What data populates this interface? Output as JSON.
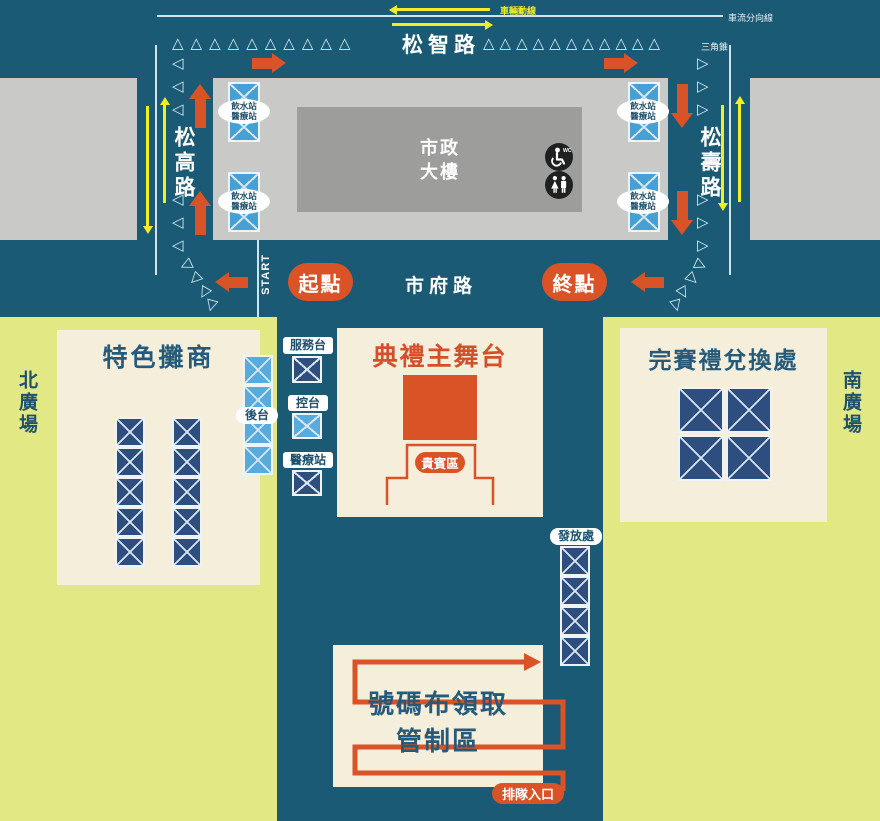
{
  "colors": {
    "background": "#1a5a74",
    "accent_red": "#d95327",
    "plaza_green": "#e2e884",
    "cream": "#f4eedb",
    "navy_box": "#2e4e7f",
    "light_blue_box": "#58abdd",
    "station_blue": "#45a0d6",
    "yellow": "#f2ee25",
    "cone_blue": "#d6edf6",
    "title_blue": "#265a7b"
  },
  "icons": {
    "cone_up": "△",
    "cone_left": "◁",
    "cone_right": "▷"
  },
  "top_legend": {
    "vehicle_route": "車輛動線",
    "lane_divider": "車流分向線",
    "cone": "三角錐"
  },
  "roads": {
    "top": "松智路",
    "left": "松高路",
    "right": "松壽路",
    "bottom": "市府路",
    "start_en": "START"
  },
  "route_points": {
    "start": "起點",
    "finish": "終點"
  },
  "building": {
    "line1": "市政",
    "line2": "大樓",
    "wc": "WC"
  },
  "station": {
    "line1": "飲水站",
    "line2": "醫療站"
  },
  "plazas": {
    "north": "北廣場",
    "south": "南廣場"
  },
  "vendor_area": {
    "title": "特色攤商",
    "column_count": 5,
    "columns": 2
  },
  "backstage": {
    "label": "後台",
    "count": 4
  },
  "ops": {
    "service": "服務台",
    "control": "控台",
    "medical": "醫療站"
  },
  "stage": {
    "title": "典禮主舞台",
    "vip": "貴賓區"
  },
  "exchange": {
    "title": "完賽禮兌換處",
    "count": 4
  },
  "distribution": {
    "label": "發放處",
    "count": 4
  },
  "bib": {
    "line1": "號碼布領取",
    "line2": "管制區",
    "entrance": "排隊入口"
  },
  "cones": {
    "top_left": 10,
    "top_right": 11,
    "left_upper": 3,
    "left_lower": 3,
    "right_upper": 3,
    "right_lower": 3
  }
}
